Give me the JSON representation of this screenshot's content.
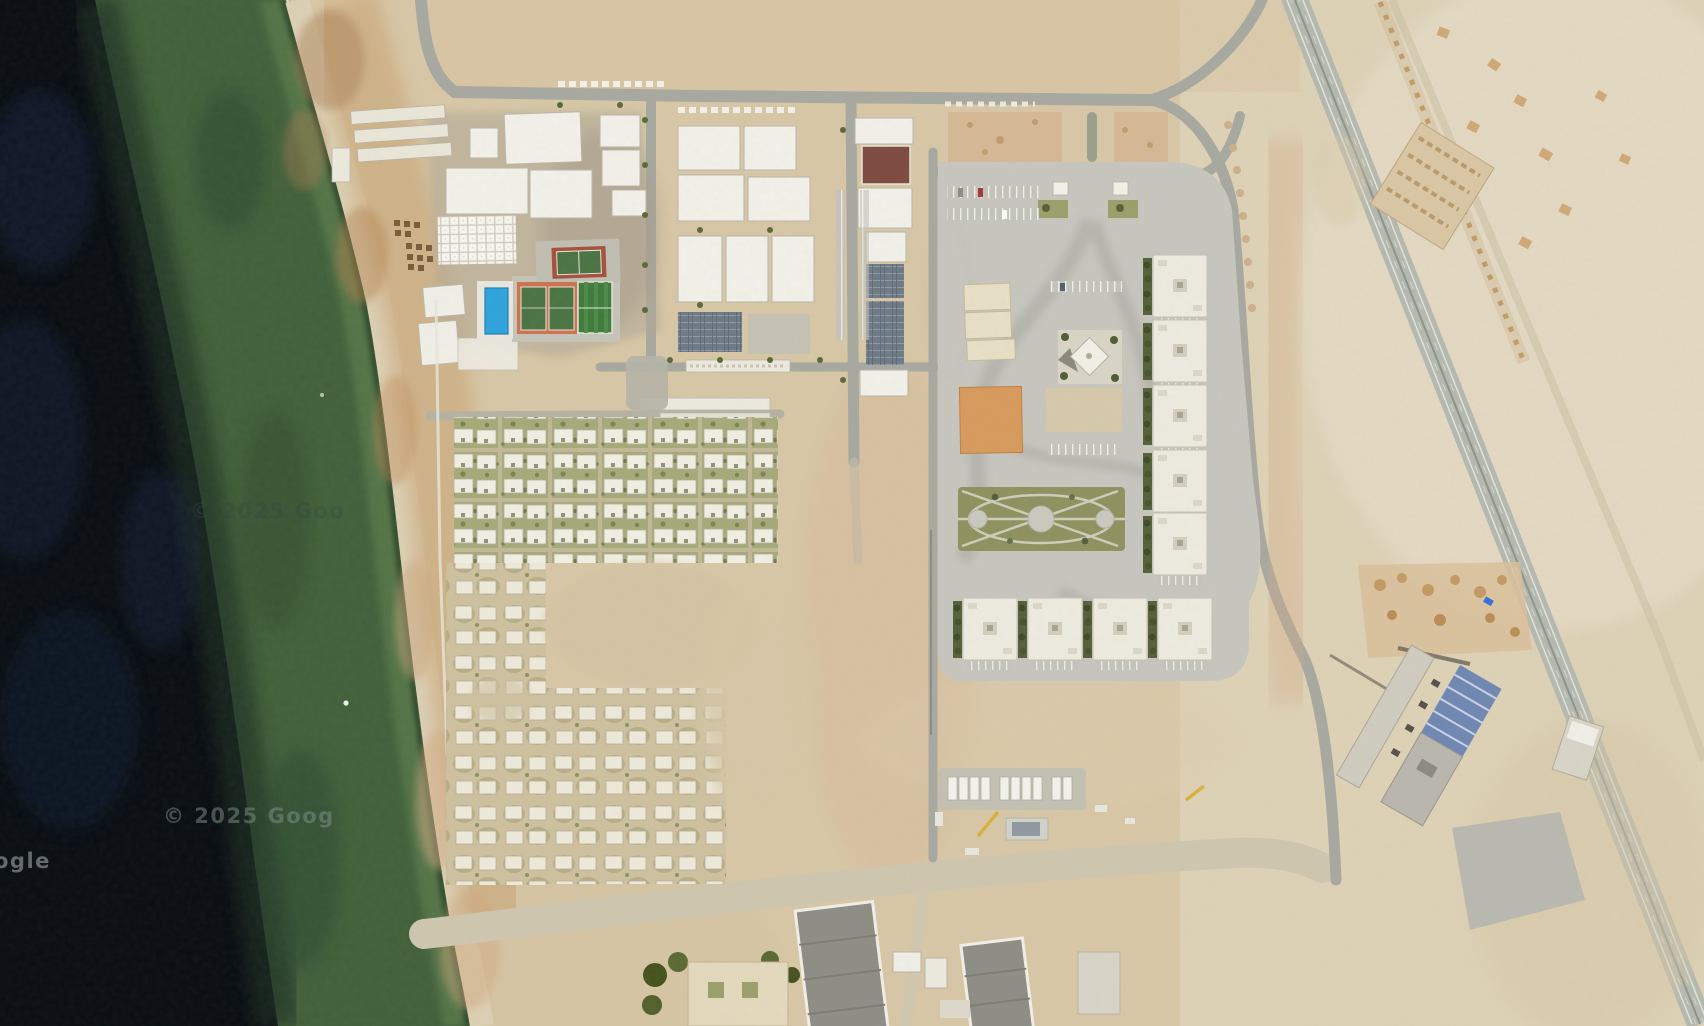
{
  "map": {
    "type": "satellite-imagery",
    "description": "aerial satellite view of a coastal desert compound with housing grid, sports facilities, gated apartment complex, highway and construction sites",
    "watermarks": [
      {
        "text": "© 2025 Goo",
        "x": 190,
        "y": 518
      },
      {
        "text": "© 2025 Goog",
        "x": 163,
        "y": 823
      },
      {
        "text": "ogle",
        "x": -6,
        "y": 868
      }
    ],
    "colors": {
      "water_deep": "#080d12",
      "water_blue_patch": "#14243e",
      "water_green": "#41603a",
      "water_green_light": "#5b7d4e",
      "surf": "#ece8d4",
      "beach": "#dcd0b4",
      "rocky_shore": "#c79e6d",
      "sand": "#d7c7a6",
      "sand_pink": "#d9bb95",
      "road": "#a7a9a0",
      "dirt_road": "#cfc6b0",
      "pavement": "#c6c6bf",
      "building_white": "#f2f1ea",
      "building_cream": "#e7dfc6",
      "pool": "#2ea3dc",
      "tennis_orange": "#cf7150",
      "court_green": "#4a7342",
      "field_green": "#3e7a3c",
      "park_green": "#8e915f",
      "vegetation": "#a6aa79",
      "tree": "#4f5c33",
      "orange_lot": "#d79a5c",
      "solar_panel": "#6e7a86",
      "red_roof": "#7d4a3e",
      "highway": "#b4b9af",
      "construction_roof_blue": "#6f87b3",
      "crane_yellow": "#d8b13c"
    },
    "features": [
      "sea",
      "beach",
      "rocky-shore",
      "industrial-warehouses",
      "shade-canopy-parking",
      "beach-umbrellas",
      "swimming-pool",
      "tennis-courts",
      "football-field",
      "basketball-court",
      "solar-panel-arrays",
      "villa-housing-grid",
      "gated-compound",
      "entrance-gate",
      "mosque",
      "central-park",
      "orange-court",
      "apartment-blocks",
      "truck-yard",
      "mobile-cranes",
      "perimeter-roads",
      "highway",
      "pier-foundation-line",
      "construction-site",
      "blue-roof-building",
      "desert-terrain"
    ]
  }
}
